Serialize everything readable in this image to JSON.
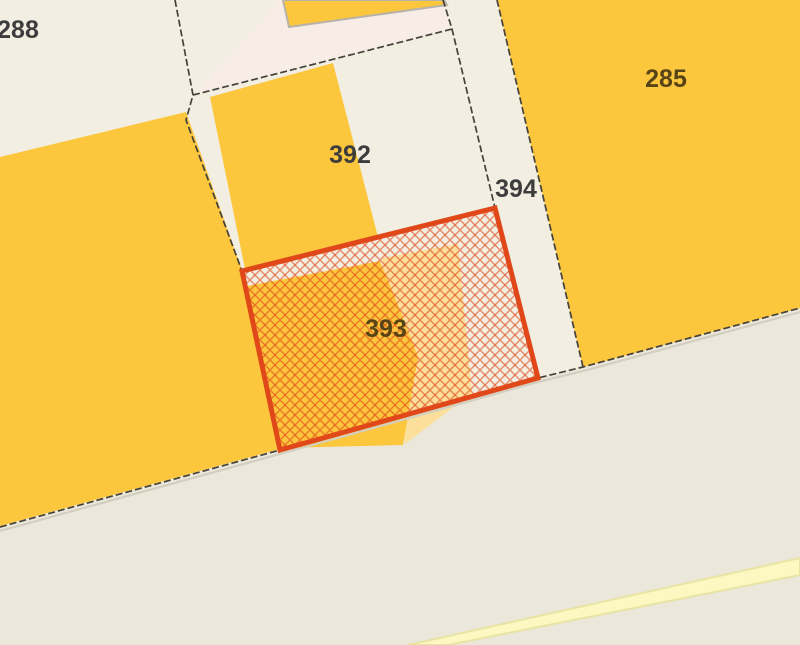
{
  "map": {
    "description": "Cadastral parcel map with one parcel highlighted by red crosshatch",
    "selected_parcel": "393",
    "labels": {
      "p288": "288",
      "p392": "392",
      "p394": "394",
      "p285": "285",
      "p393": "393"
    },
    "colors": {
      "background": "#f2eee2",
      "road": "#ebe7da",
      "parcel_tint_pink": "#f7ece6",
      "building_yellow": "#fcc63d",
      "building_pale_yellow": "#fbdf9b",
      "road_stripe": "#fbf8c2",
      "road_stripe_edge": "#e8e4a4",
      "boundary_line": "#45423a",
      "road_edge_shadow": "#d2cec0",
      "building_outline": "#b7b3a8",
      "highlight_red": "#e0481a",
      "label_dark": "#3d3d3d",
      "label_olive": "#574416"
    }
  }
}
